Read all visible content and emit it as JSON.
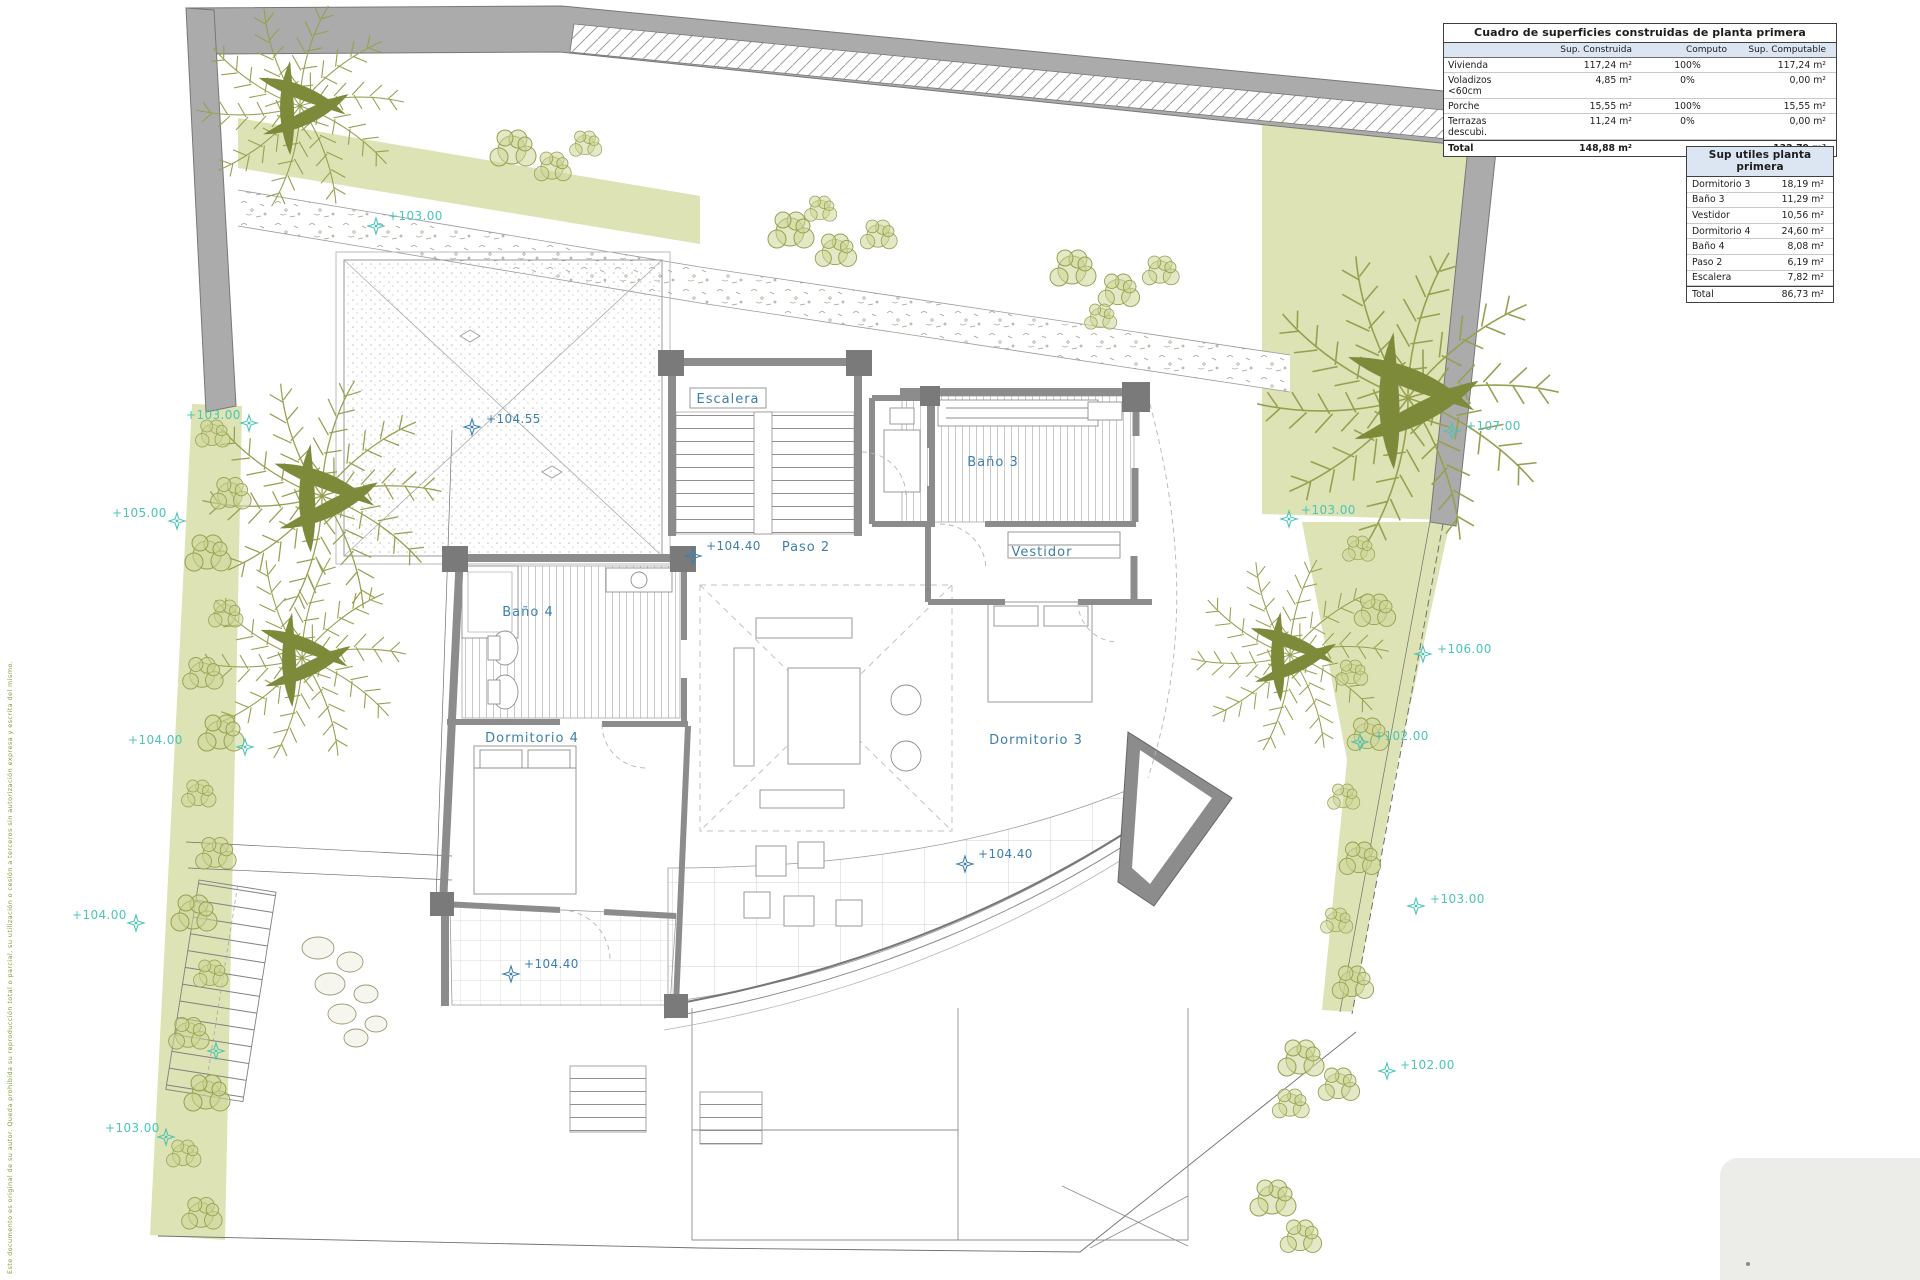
{
  "colors": {
    "garden_green": "#dde3b4",
    "hedge_olive": "#96a04e",
    "road_gray": "#ababab",
    "wall_gray": "#8c8c8c",
    "site_marker_teal": "#4cc4b7",
    "plan_label_blue": "#3c7fad",
    "table_header_bg": "#dce6f2"
  },
  "symbols": {
    "level_marker_icon": "survey-star-icon"
  },
  "tables": {
    "construidas": {
      "title": "Cuadro de superficies construidas de planta primera",
      "col_headers": [
        "",
        "Sup. Construida",
        "Computo",
        "Sup. Computable"
      ],
      "rows": [
        {
          "label": "Vivienda",
          "construida": "117,24 m²",
          "computo": "100%",
          "computable": "117,24 m²"
        },
        {
          "label": "Voladizos <60cm",
          "construida": "4,85 m²",
          "computo": "0%",
          "computable": "0,00 m²"
        },
        {
          "label": "Porche",
          "construida": "15,55 m²",
          "computo": "100%",
          "computable": "15,55 m²"
        },
        {
          "label": "Terrazas descubi.",
          "construida": "11,24 m²",
          "computo": "0%",
          "computable": "0,00 m²"
        }
      ],
      "total": {
        "label": "Total",
        "construida": "148,88 m²",
        "computo": "",
        "computable": "132,79 m²"
      }
    },
    "utiles": {
      "title": "Sup utiles planta primera",
      "rows": [
        {
          "label": "Dormitorio 3",
          "value": "18,19 m²"
        },
        {
          "label": "Baño 3",
          "value": "11,29 m²"
        },
        {
          "label": "Vestidor",
          "value": "10,56 m²"
        },
        {
          "label": "Dormitorio 4",
          "value": "24,60 m²"
        },
        {
          "label": "Baño 4",
          "value": "8,08 m²"
        },
        {
          "label": "Paso 2",
          "value": "6,19 m²"
        },
        {
          "label": "Escalera",
          "value": "7,82 m²"
        }
      ],
      "total": {
        "label": "Total",
        "value": "86,73 m²"
      }
    }
  },
  "plan": {
    "room_labels": [
      {
        "text": "Escalera",
        "x": 728,
        "y": 403,
        "boxed": true
      },
      {
        "text": "Baño 3",
        "x": 993,
        "y": 466
      },
      {
        "text": "Paso 2",
        "x": 806,
        "y": 551
      },
      {
        "text": "Vestidor",
        "x": 1042,
        "y": 556
      },
      {
        "text": "Baño 4",
        "x": 528,
        "y": 616
      },
      {
        "text": "Dormitorio 4",
        "x": 532,
        "y": 742
      },
      {
        "text": "Dormitorio 3",
        "x": 1036,
        "y": 744
      }
    ],
    "level_markers": [
      {
        "text": "+104.55",
        "tx": 486,
        "ty": 423,
        "mx": 472,
        "my": 427
      },
      {
        "text": "+104.40",
        "tx": 706,
        "ty": 550,
        "mx": 693,
        "my": 556
      },
      {
        "text": "+104.40",
        "tx": 978,
        "ty": 858,
        "mx": 965,
        "my": 864
      },
      {
        "text": "+104.40",
        "tx": 524,
        "ty": 968,
        "mx": 511,
        "my": 974
      }
    ],
    "site_markers": [
      {
        "text": "+103.00",
        "tx": 388,
        "ty": 220,
        "mx": 376,
        "my": 226
      },
      {
        "text": "+103.00",
        "tx": 186,
        "ty": 419,
        "mx": 249,
        "my": 423
      },
      {
        "text": "+105.00",
        "tx": 112,
        "ty": 517,
        "mx": 177,
        "my": 521
      },
      {
        "text": "+104.00",
        "tx": 128,
        "ty": 744,
        "mx": 245,
        "my": 747
      },
      {
        "text": "+104.00",
        "tx": 72,
        "ty": 919,
        "mx": 136,
        "my": 923
      },
      {
        "text": "",
        "tx": 190,
        "ty": 1046,
        "mx": 216,
        "my": 1051
      },
      {
        "text": "+103.00",
        "tx": 105,
        "ty": 1132,
        "mx": 166,
        "my": 1137
      },
      {
        "text": "+107.00",
        "tx": 1466,
        "ty": 430,
        "mx": 1452,
        "my": 431
      },
      {
        "text": "+103.00",
        "tx": 1301,
        "ty": 514,
        "mx": 1289,
        "my": 519
      },
      {
        "text": "+106.00",
        "tx": 1437,
        "ty": 653,
        "mx": 1423,
        "my": 654
      },
      {
        "text": "+102.00",
        "tx": 1374,
        "ty": 740,
        "mx": 1360,
        "my": 742
      },
      {
        "text": "+103.00",
        "tx": 1430,
        "ty": 903,
        "mx": 1416,
        "my": 906
      },
      {
        "text": "+102.00",
        "tx": 1400,
        "ty": 1069,
        "mx": 1387,
        "my": 1071
      }
    ]
  },
  "fine_print": "Este documento es original de su autor. Queda prohibida su reproducción total o parcial, su utilización o cesión a terceros sin autorización expresa y escrita del mismo."
}
